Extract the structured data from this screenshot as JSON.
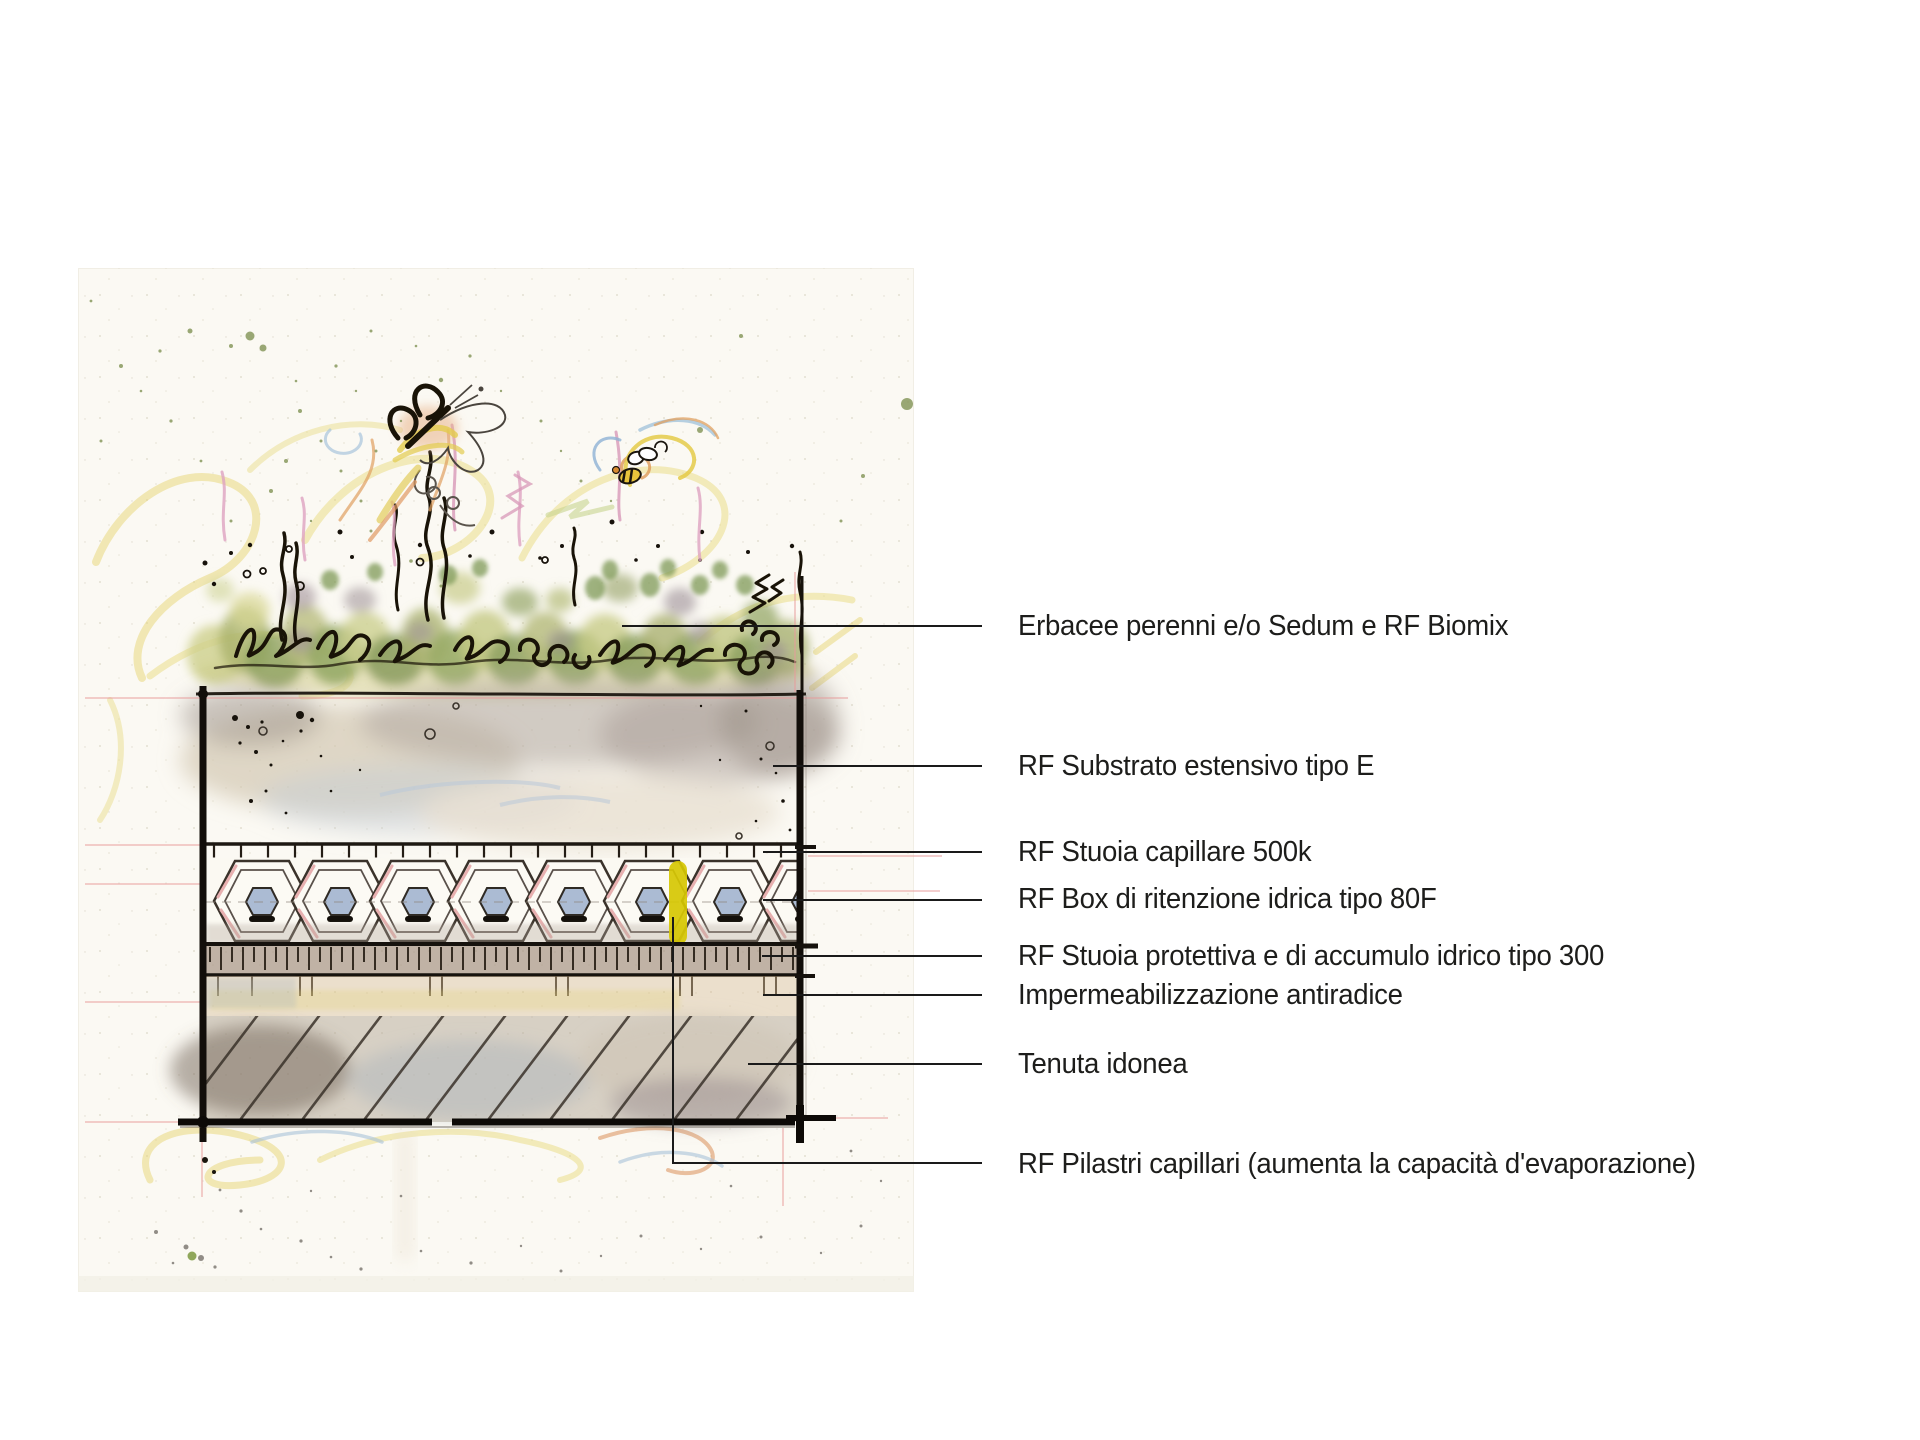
{
  "diagram": {
    "labels": [
      {
        "id": "vegetation",
        "text": "Erbacee perenni e/o Sedum e RF Biomix"
      },
      {
        "id": "substrate",
        "text": "RF Substrato estensivo tipo E"
      },
      {
        "id": "capillary-mat",
        "text": "RF Stuoia capillare 500k"
      },
      {
        "id": "retention-box",
        "text": "RF Box di ritenzione idrica tipo 80F"
      },
      {
        "id": "protective-mat",
        "text": "RF Stuoia protettiva e di accumulo idrico tipo 300"
      },
      {
        "id": "waterproofing",
        "text": "Impermeabilizzazione antiradice"
      },
      {
        "id": "roof-deck",
        "text": "Tenuta idonea"
      },
      {
        "id": "capillary-pillars",
        "text": "RF Pilastri capillari (aumenta la capacità d'evaporazione)"
      }
    ],
    "palette": {
      "label_text": "#1d1d1b",
      "leader_line": "#1a1a1a",
      "ink": "#191307",
      "grass_green": "#8ca05c",
      "grass_yellow_green": "#cdd08c",
      "crayon_yellow": "#e7d674",
      "pencil_pink": "#dfa3c0",
      "pillar_yellow": "#d6c702",
      "hex_core_blue": "#93a9c9",
      "substrate_wash": "#c9bfb2",
      "deck_wash": "#a5988a",
      "paper": "#fbf9f3"
    }
  }
}
